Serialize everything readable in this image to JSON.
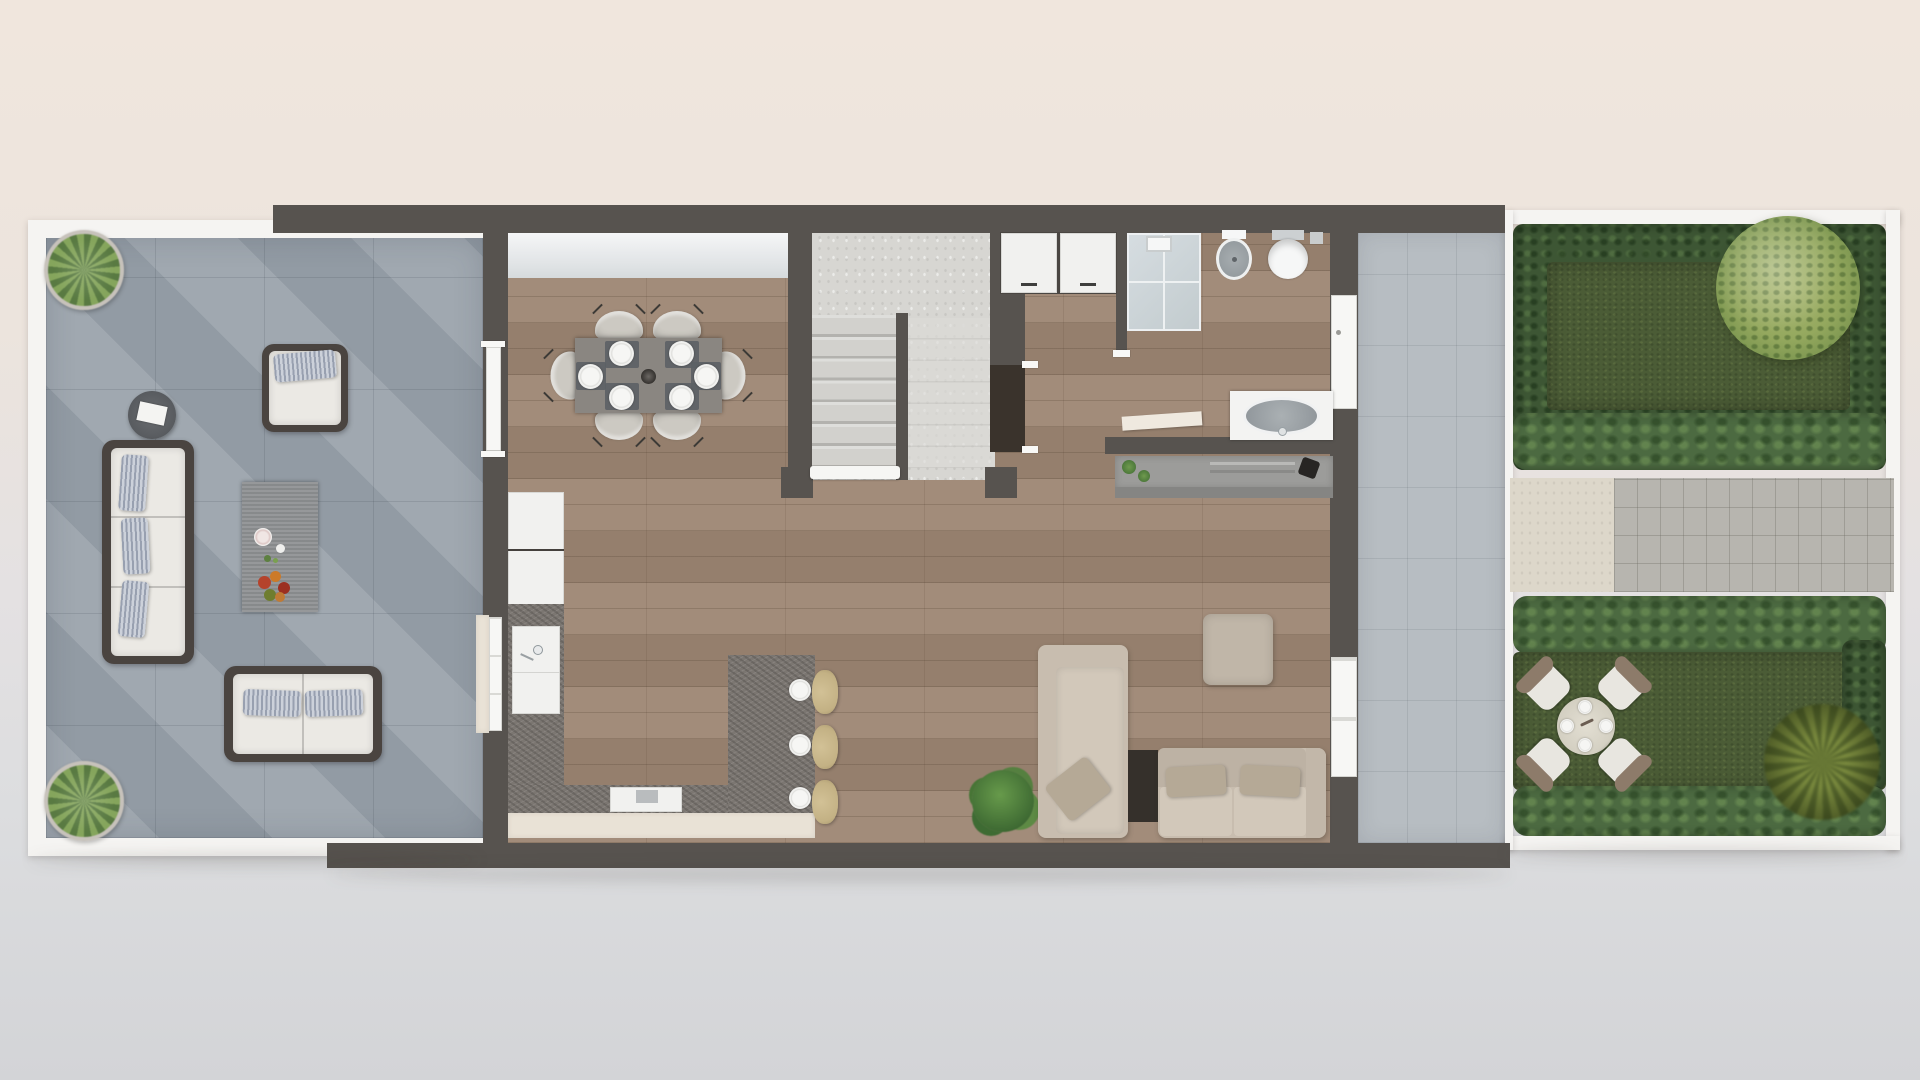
{
  "scene": {
    "kind": "3d-floor-plan-top-view",
    "storey": "ground-floor",
    "visible_text": "none"
  },
  "palette": {
    "background_top": "#f0e6dd",
    "background_bottom": "#d3d4d7",
    "wall": "#57534f",
    "frame_white": "#f5f4f2",
    "terrace_tile": "#9aa3ab",
    "passage_tile": "#b7bdc2",
    "wood": "#9d8673",
    "concrete": "#d7d6d2",
    "granite": "#7b7671",
    "cabinet_cream": "#e9e2d6",
    "unit_white": "#f1f1ef",
    "door_white": "#f7f7f5",
    "dark_opening": "#3a332c",
    "sofa_frame": "#4a4440",
    "cushion_white": "#ebe9e4",
    "pillow_stripe": "#98a0b0",
    "lounge_sofa": "#c8bdaf",
    "lounge_pillow": "#b5a996",
    "pouf": "#c0b6a8",
    "stool": "#c3b184",
    "dining_table": "#8a8681",
    "chair": "#ccc9c2",
    "placemat": "#5c6065",
    "hedge": "#3d5634",
    "hedge_bright": "#4c6a41",
    "lawn": "#4b5c36",
    "tree": "#9aab67",
    "palm": "#6d7a38",
    "path_cream": "#ddd7ca",
    "paver": "#b7b5af",
    "fixture_white": "#f6f7f7",
    "sink_grey": "#9aa0a4",
    "wicker_back": "#8d7b6a",
    "plant_green": "#4f7a3c"
  },
  "areas": {
    "terrace": {
      "items": [
        "grass-planter",
        "grass-planter",
        "wicker-armchair",
        "round-side-table-with-book",
        "three-seat-wicker-sofa",
        "coffee-table-with-flowers",
        "two-seat-wicker-loveseat"
      ]
    },
    "dining": {
      "items": [
        "rectangular-table",
        "six-chairs",
        "six-place-settings",
        "center-bowl"
      ]
    },
    "stairs": {
      "items": [
        "double-flight-staircase",
        "divider-wall",
        "bottom-railing"
      ]
    },
    "laundry": {
      "items": [
        "two-white-appliances",
        "understair-doorway"
      ]
    },
    "bathroom": {
      "items": [
        "walk-in-shower",
        "bidet",
        "toilet",
        "vanity-with-oval-basin",
        "towel-bench",
        "grey-sideboard-with-plants-and-vase"
      ]
    },
    "kitchen": {
      "items": [
        "tall-white-cabinets",
        "sink-unit",
        "granite-l-counter",
        "cooktop-module",
        "island-breakfast-bar",
        "three-bar-stools",
        "three-place-settings"
      ]
    },
    "lounge": {
      "items": [
        "corner-sofa-with-chaise",
        "dark-side-console",
        "square-pouf",
        "potted-plant"
      ]
    },
    "side_passage": {
      "items": [
        "grey-tiled-walkway",
        "front-door",
        "patio-door"
      ]
    },
    "garden": {
      "items": [
        "white-fence",
        "boxwood-hedges",
        "upper-lawn",
        "round-tree",
        "paver-path",
        "lower-lawn",
        "round-dining-table",
        "four-wicker-chairs",
        "palm-shrub"
      ]
    }
  },
  "counts": {
    "dining_chairs": 6,
    "dining_plates": 6,
    "bar_stools": 3,
    "island_plates": 3,
    "garden_chairs": 4,
    "terrace_planters": 2,
    "appliances": 2
  }
}
